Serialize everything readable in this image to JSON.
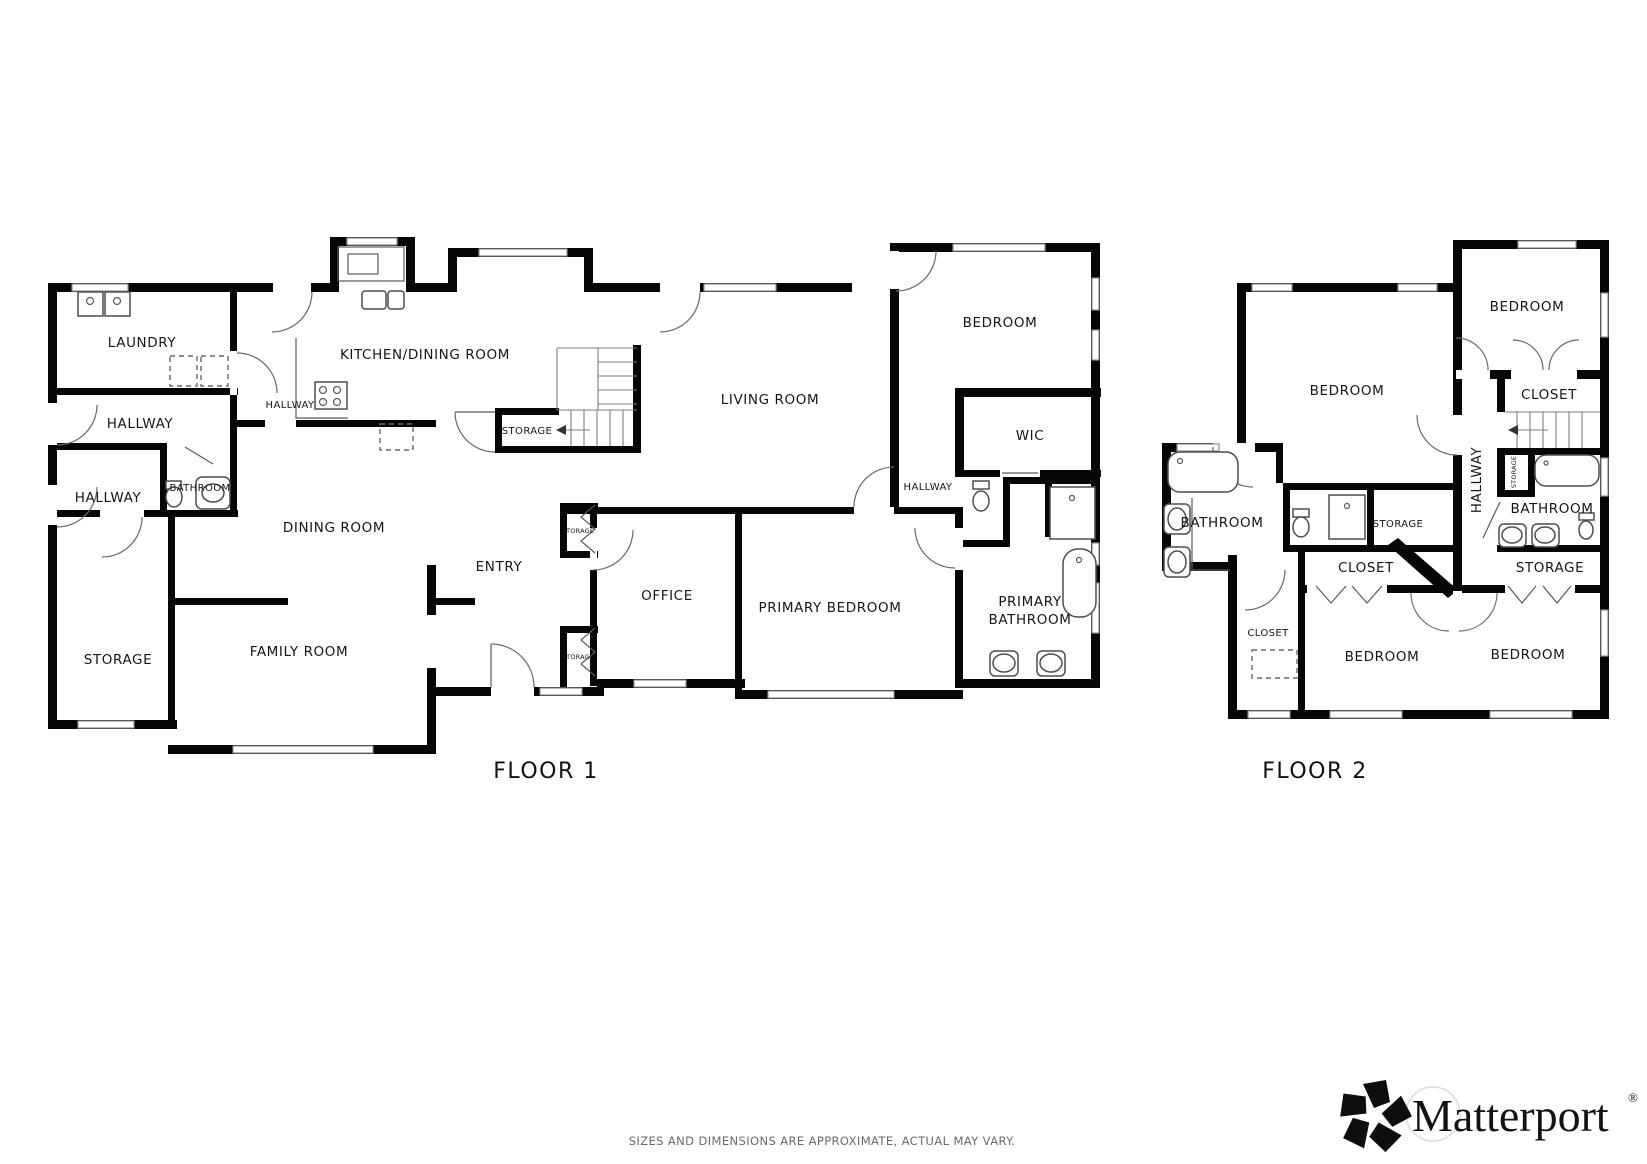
{
  "floor1": {
    "title": "FLOOR 1",
    "labels": {
      "laundry": "LAUNDRY",
      "hallway_top": "HALLWAY",
      "hallway_left": "HALLWAY",
      "bathroom": "BATHROOM",
      "storage": "STORAGE",
      "family_room": "FAMILY ROOM",
      "dining_room": "DINING ROOM",
      "kitchen_dining_room": "KITCHEN/DINING ROOM",
      "hallway_kitchen": "HALLWAY",
      "storage_under_stairs": "STORAGE",
      "entry": "ENTRY",
      "storage_closet_top": "STORAGE",
      "storage_closet_bottom": "STORAGE",
      "office": "OFFICE",
      "living_room": "LIVING ROOM",
      "bedroom": "BEDROOM",
      "wic": "WIC",
      "hallway_suite": "HALLWAY",
      "primary_bedroom": "PRIMARY BEDROOM",
      "primary_bathroom_line1": "PRIMARY",
      "primary_bathroom_line2": "BATHROOM"
    }
  },
  "floor2": {
    "title": "FLOOR 2",
    "labels": {
      "bedroom_left": "BEDROOM",
      "bedroom_top_right": "BEDROOM",
      "closet_top_right": "CLOSET",
      "hallway": "HALLWAY",
      "storage_hall": "STORAGE",
      "bathroom_right": "BATHROOM",
      "storage_right": "STORAGE",
      "bathroom_left": "BATHROOM",
      "storage_middle": "STORAGE",
      "closet_middle": "CLOSET",
      "closet_left": "CLOSET",
      "bedroom_bottom_middle": "BEDROOM",
      "bedroom_bottom_right": "BEDROOM"
    }
  },
  "footer": {
    "disclaimer": "SIZES AND DIMENSIONS ARE APPROXIMATE, ACTUAL MAY VARY.",
    "brand": "Matterport",
    "registered_mark": "®"
  },
  "colors": {
    "wall": "#060606",
    "label_text": "#161616",
    "disclaimer_text": "#6a6a6a",
    "background": "#ffffff"
  }
}
